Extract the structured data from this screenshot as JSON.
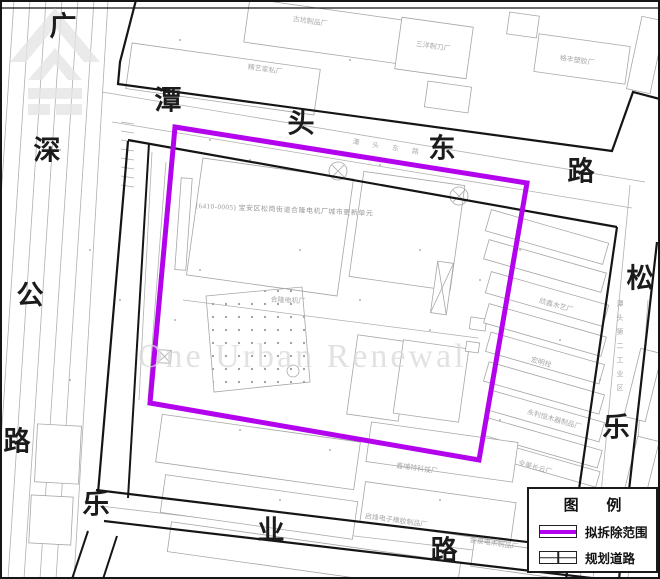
{
  "map": {
    "unit_label": "(6410-0005) 宝安区松岗街道合隆电机厂城市更新单元",
    "watermark_text": "One Urban Renewal",
    "roads": {
      "left": [
        "广",
        "深",
        "公",
        "路"
      ],
      "top": [
        "潭",
        "头",
        "东",
        "路"
      ],
      "right": [
        "松",
        "乐"
      ],
      "bottom": [
        "乐",
        "业",
        "路"
      ],
      "top_minor": "潭头东路",
      "right_minor": "潭头第二工业区"
    },
    "factories": [
      "古坑制品厂",
      "精艺家私厂",
      "三洋制刀厂",
      "格丰塑胶厂",
      "欣鑫木艺厂",
      "宏明栓",
      "永利恒木器制品厂",
      "全美长云厂",
      "鑫埔特科技厂",
      "启烽电子橡胶制品厂",
      "金泉电木制品厂",
      "合隆电机厂"
    ]
  },
  "legend": {
    "title": "图 例",
    "items": [
      {
        "label": "拟拆除范围"
      },
      {
        "label": "规划道路"
      }
    ]
  },
  "colors": {
    "demolition_outline": "#b303ec",
    "road_line": "#151515",
    "parcel_line": "#b0b0b0",
    "label_gray": "#a8a8a8",
    "watermark_gray": "#d9d9d9"
  }
}
